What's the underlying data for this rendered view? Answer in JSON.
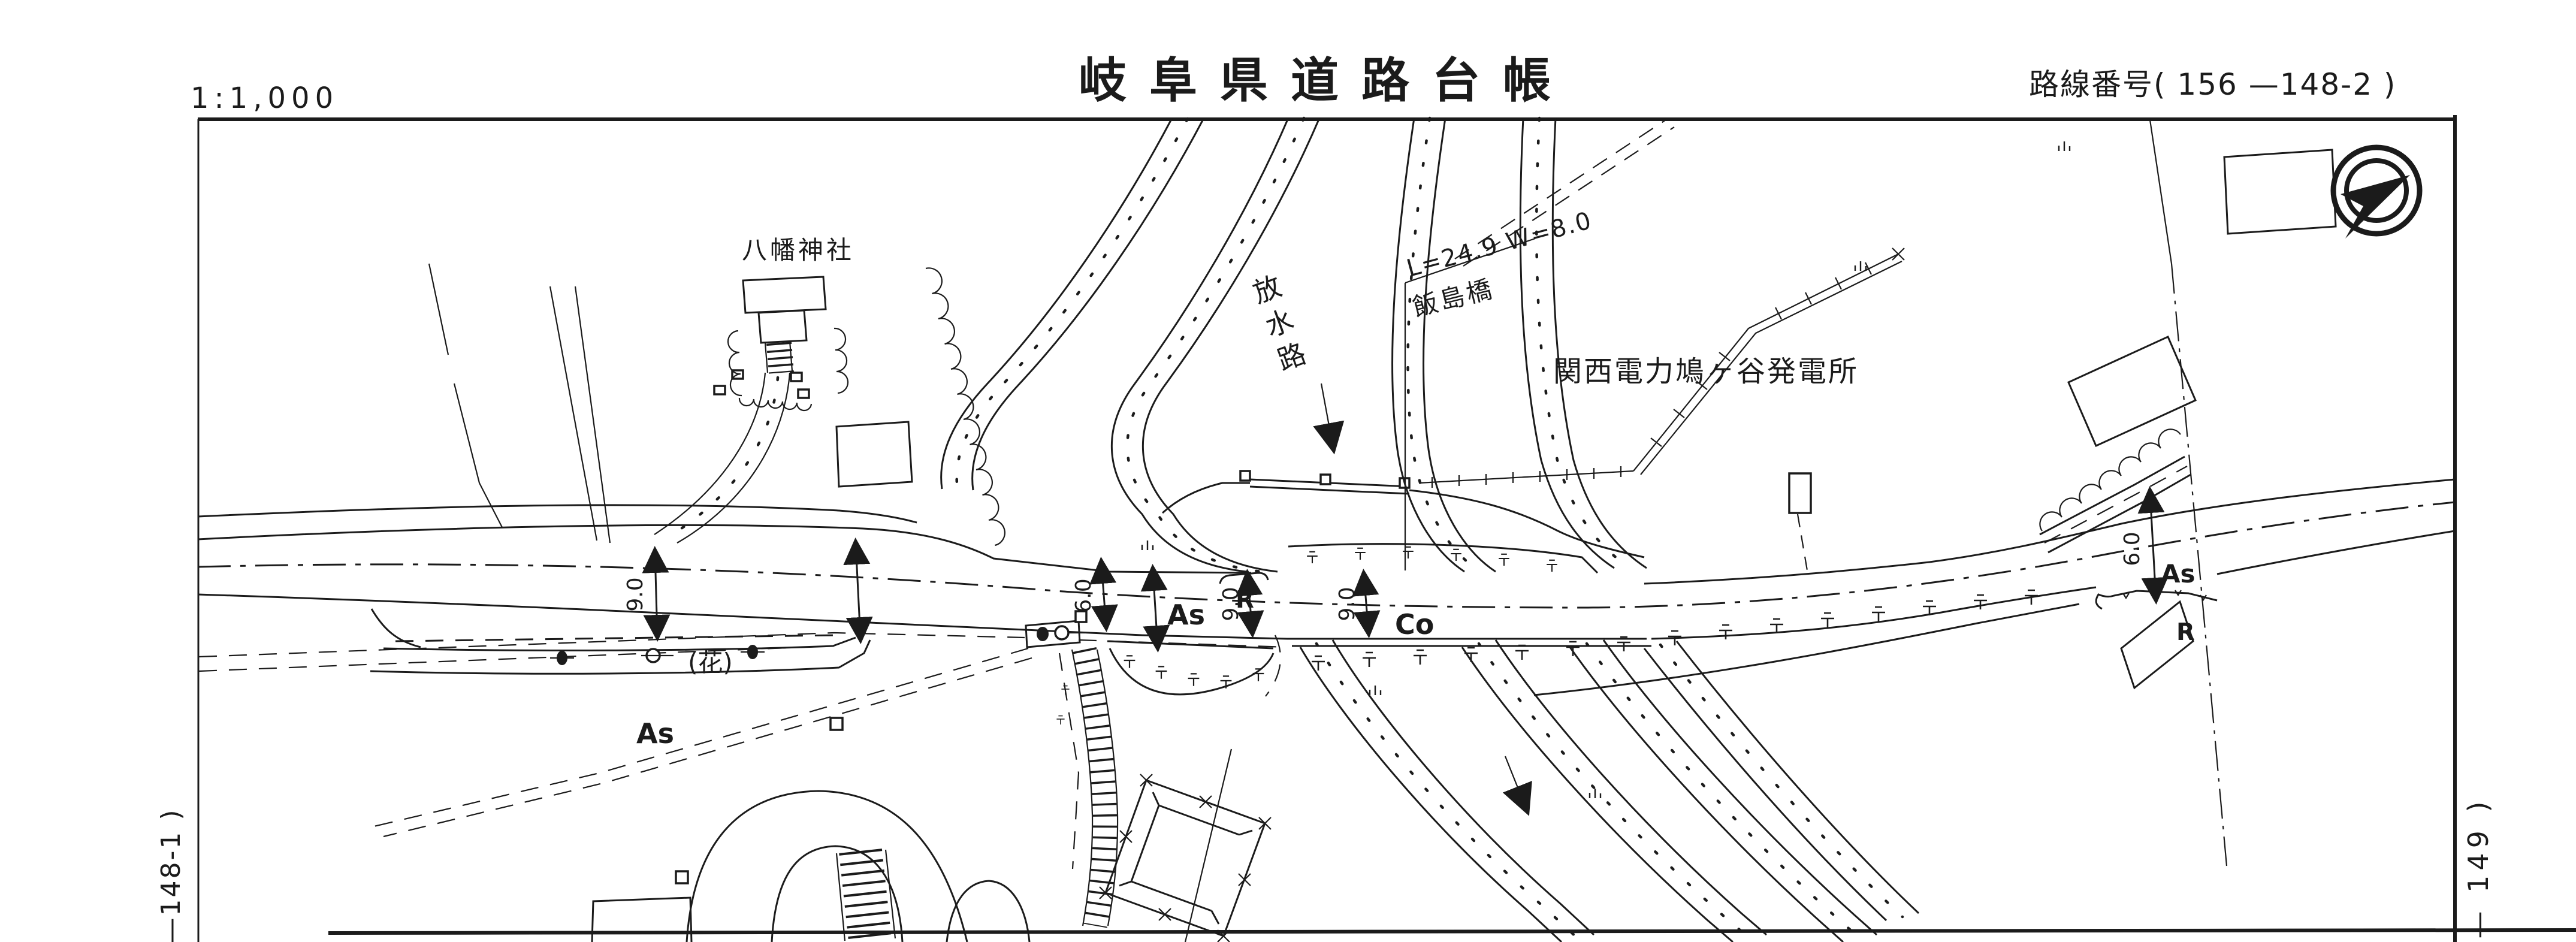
{
  "header": {
    "scale": "1:1,000",
    "title": "岐阜県道路台帳",
    "route_number": "路線番号( 156  —148-2 )"
  },
  "sheet_refs": {
    "left": "—148-1 )",
    "right": "— 149 )"
  },
  "map": {
    "landmarks": {
      "shrine": "八幡神社",
      "spillway": "放水路",
      "bridge_dim": "L=24.9  W=8.0",
      "bridge_name": "飯島橋",
      "power_plant": "関西電力鳩ヶ谷発電所"
    },
    "surface_labels": {
      "asphalt": "As",
      "concrete": "Co",
      "guardrail": "R",
      "planting": "(花)"
    },
    "dimensions": {
      "width_9": "9.0",
      "width_6": "6.0"
    },
    "compass": "north-arrow"
  },
  "theme": {
    "ink": "#1b1b1b",
    "paper": "#ffffff"
  }
}
